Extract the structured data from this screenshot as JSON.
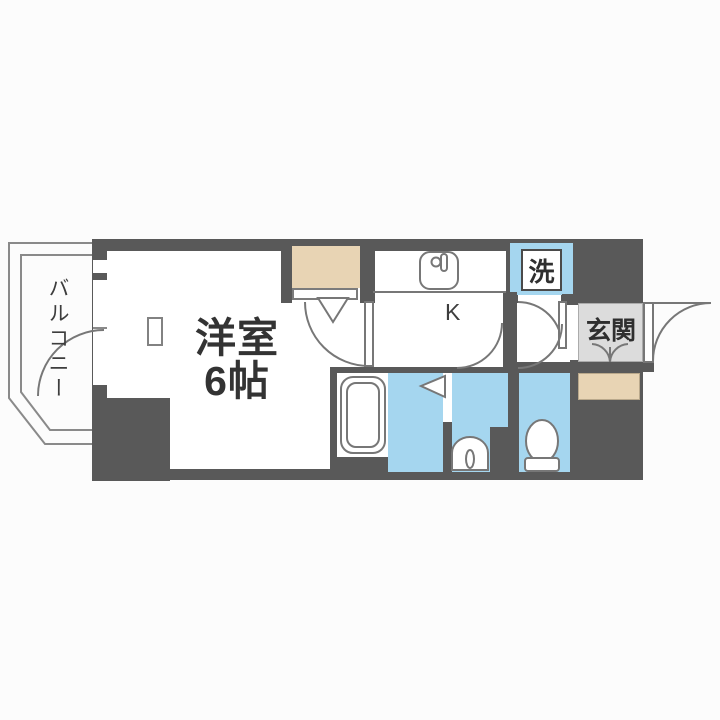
{
  "plan": {
    "title": "1K apartment floor plan",
    "rooms": {
      "main_room": {
        "label_line1": "洋室",
        "label_line2": "6帖"
      },
      "balcony": {
        "label": "バルコニー"
      },
      "kitchen": {
        "label": "K"
      },
      "entrance": {
        "label": "玄関"
      },
      "washer": {
        "label": "洗"
      }
    },
    "fixtures": [
      "bathtub",
      "kitchen-sink",
      "kitchen-faucet",
      "washbasin",
      "toilet",
      "washing-machine-pan",
      "shoe-cabinet",
      "closet",
      "pillar",
      "entrance-door",
      "balcony-railing"
    ],
    "colors": {
      "wall": "#595959",
      "water": "#A5D6EF",
      "beige": "#E8D4B4",
      "genkan": "#DCDCDC",
      "line": "#777777",
      "text": "#333333",
      "bg": "#FCFCFC"
    }
  }
}
